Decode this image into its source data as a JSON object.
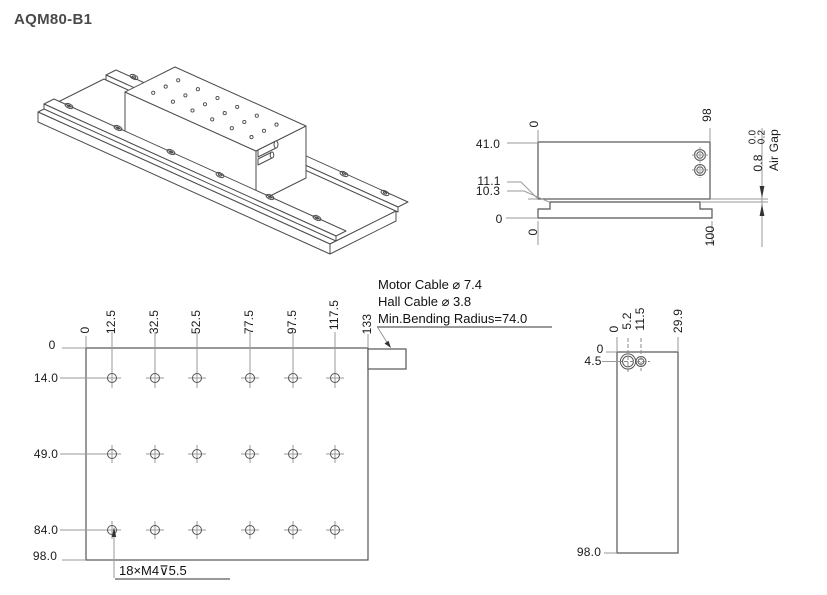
{
  "title": "AQM80-B1",
  "colors": {
    "object_line": "#545454",
    "thin_line": "#9a9a9a",
    "text": "#1a1a1a",
    "title_text": "#4a4a4a"
  },
  "side_view": {
    "top_dims": [
      "0",
      "98"
    ],
    "left_dims": [
      "41.0",
      "11.1",
      "10.3",
      "0"
    ],
    "bottom_dims": [
      "0",
      "100"
    ],
    "air_gap": {
      "tol_upper": "0.0",
      "tol_lower": "0.2",
      "value": "0.8",
      "label": "Air Gap"
    }
  },
  "plan_view": {
    "col_dims": [
      "0",
      "12.5",
      "32.5",
      "52.5",
      "77.5",
      "97.5",
      "117.5",
      "133"
    ],
    "row_dims": [
      "0",
      "14.0",
      "49.0",
      "84.0",
      "98.0"
    ],
    "thread_note": "18×M4⊽5.5",
    "cable_notes": [
      "Motor Cable ⌀ 7.4",
      "Hall Cable ⌀ 3.8",
      "Min.Bending Radius=74.0"
    ]
  },
  "end_view": {
    "col_dims": [
      "0",
      "5.2",
      "11.5",
      "29.9"
    ],
    "row_dims": [
      "0",
      "4.5",
      "98.0"
    ]
  }
}
